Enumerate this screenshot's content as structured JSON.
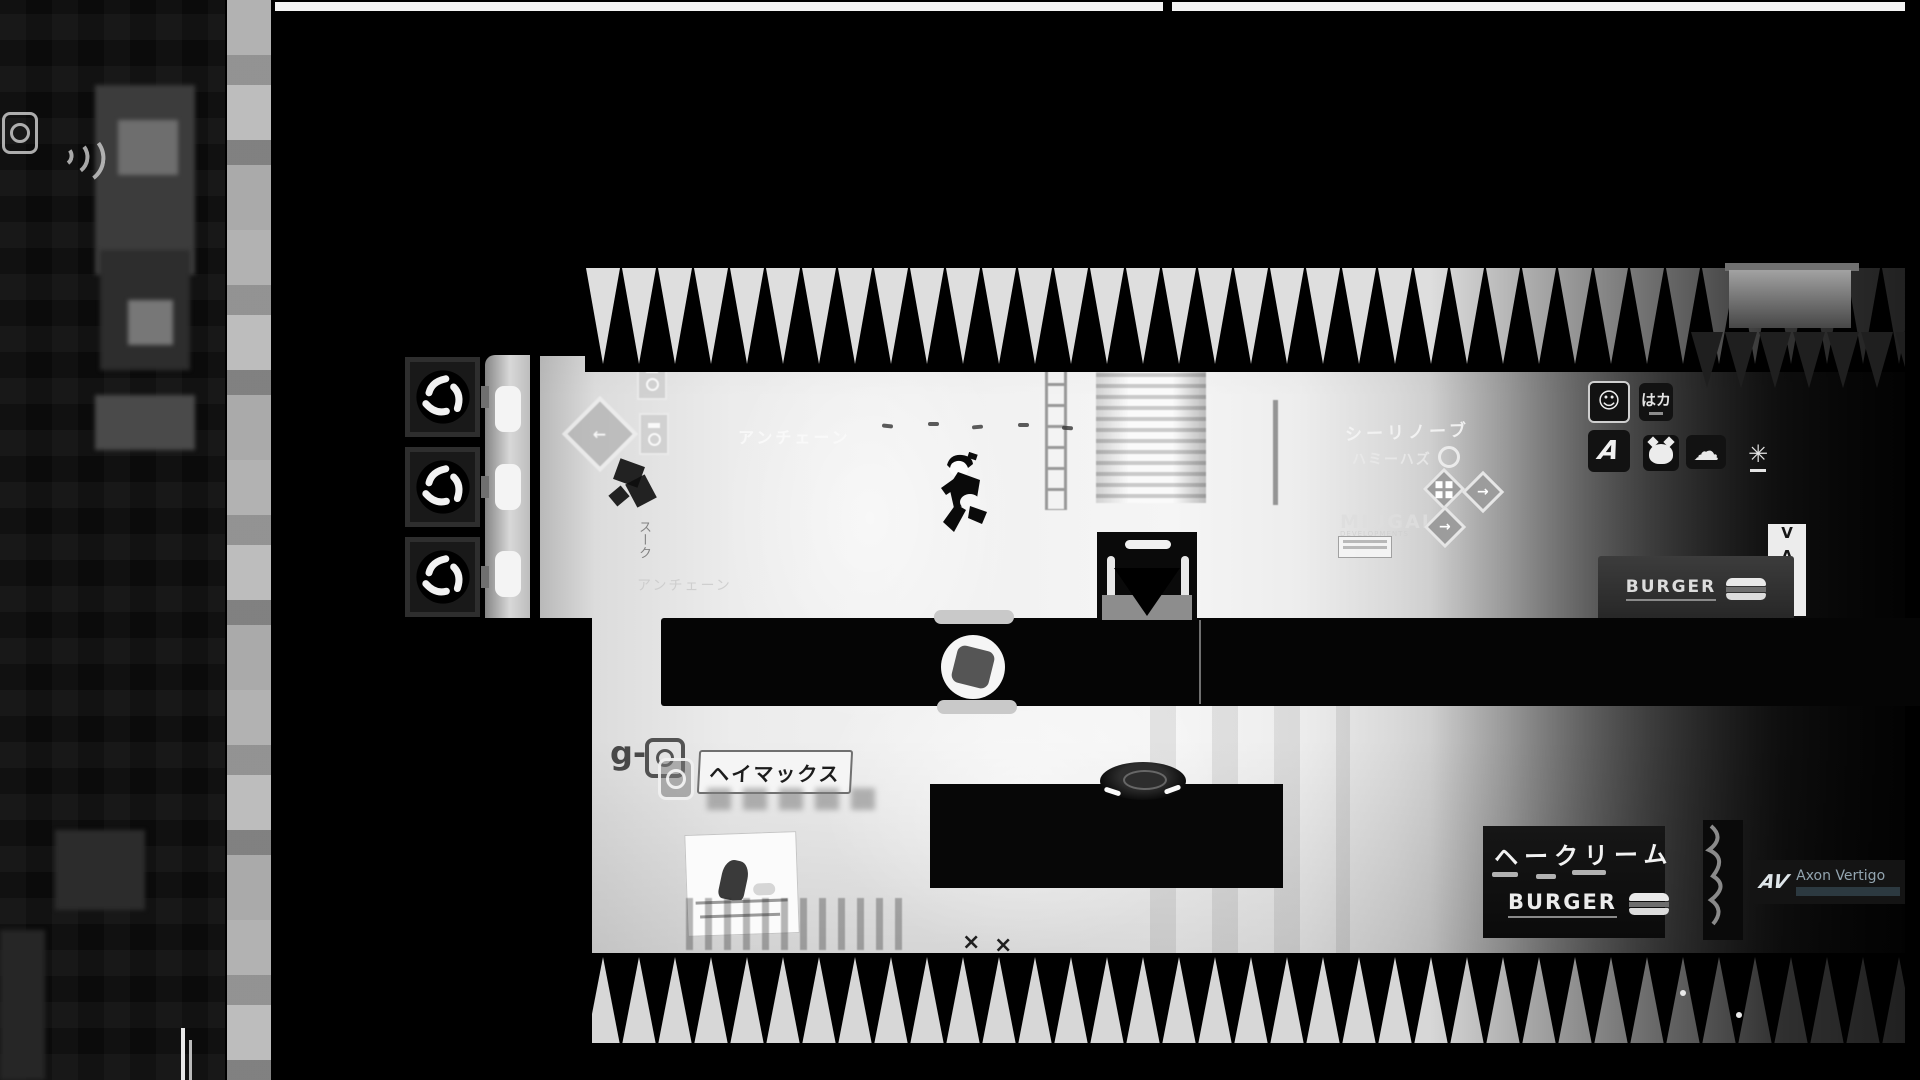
{
  "palette": {
    "void": "#000000",
    "room_light": "#f2f2f2",
    "spike_light": "#dedede",
    "platform_black": "#050505",
    "shadow_dark": "#0d0d0d",
    "sign_white": "#f5f5f5"
  },
  "glyphs": {
    "smiley": "☺",
    "cloud": "☁",
    "sparkle": "✳",
    "arrow_left": "←",
    "arrow_right": "→",
    "cross": "×",
    "a_logo": "A"
  },
  "signs": {
    "unchain_upper": "アンチェーン",
    "unchain_lower": "アンチェーン",
    "vertical_left": "スーク",
    "g_mark": "g-",
    "heimax": "ヘイマックス",
    "miugai": "MIUGAI",
    "miugai_sub": "DEVELOPMENTS",
    "neon_line1": "シーリノーブ",
    "neon_line2": "ハミーハズ",
    "haka": "はカ",
    "vast": "VAST",
    "burger_upper": "BURGER",
    "burger_lower": "BURGER",
    "cream": "ヘークリーム",
    "axon_logo": "AV",
    "axon": "Axon Vertigo"
  }
}
